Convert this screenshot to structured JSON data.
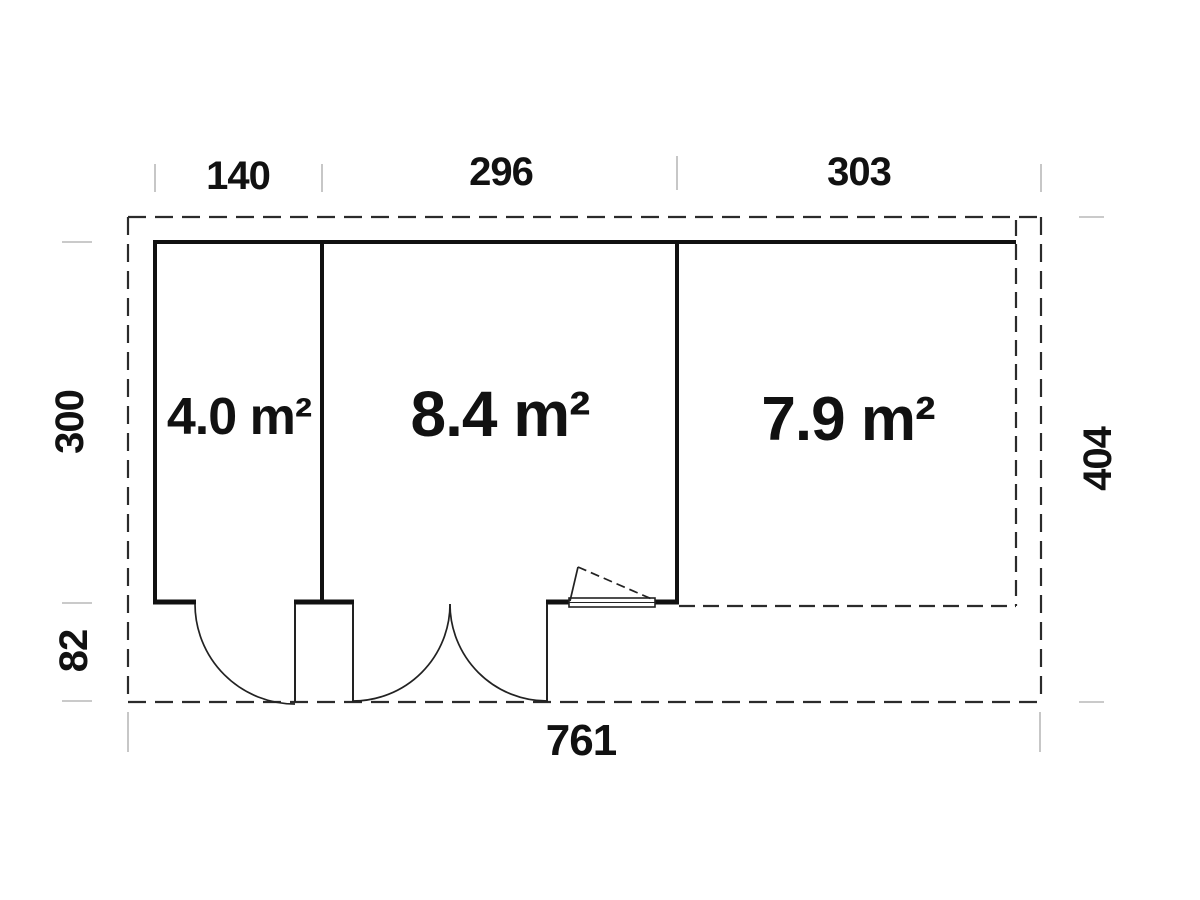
{
  "plan": {
    "type": "floor-plan",
    "rooms": [
      {
        "id": "room-1",
        "area": "4.0 m²"
      },
      {
        "id": "room-2",
        "area": "8.4 m²"
      },
      {
        "id": "room-3",
        "area": "7.9 m²"
      }
    ],
    "dimensions": {
      "top": [
        "140",
        "296",
        "303"
      ],
      "left_main_depth": "300",
      "left_porch_depth": "82",
      "right_total_depth": "404",
      "bottom_total_width": "761"
    },
    "colors": {
      "wall_line": "#111111",
      "dashed_line": "#2b2b2b",
      "thin_line": "#222222",
      "tick": "#b9b9b9",
      "background": "#ffffff"
    }
  }
}
